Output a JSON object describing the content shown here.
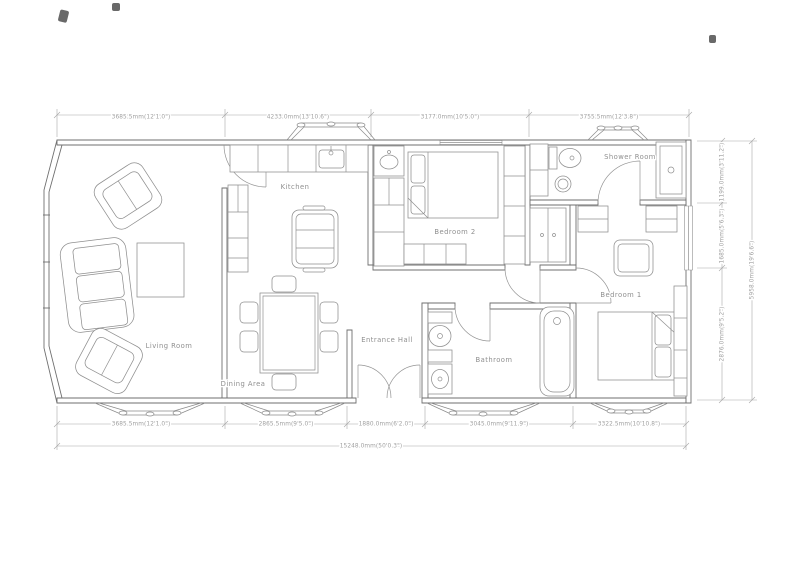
{
  "rooms": {
    "living_room": "Living Room",
    "dining_area": "Dining Area",
    "kitchen": "Kitchen",
    "entrance_hall": "Entrance Hall",
    "bathroom": "Bathroom",
    "bedroom_2": "Bedroom 2",
    "bedroom_1": "Bedroom 1",
    "shower_room": "Shower Room"
  },
  "dimensions": {
    "top": [
      "3685.5mm(12'1.0\")",
      "4233.0mm(13'10.6\")",
      "3177.0mm(10'5.0\")",
      "3755.5mm(12'3.8\")"
    ],
    "bottom": [
      "3685.5mm(12'1.0\")",
      "2865.5mm(9'5.0\")",
      "1880.0mm(6'2.0\")",
      "3045.0mm(9'11.9\")",
      "3322.5mm(10'10.8\")"
    ],
    "bottom_total": "15248.0mm(50'0.3\")",
    "right": [
      "1199.0mm(3'11.2\")",
      "1685.0mm(5'6.3\")",
      "2876.0mm(9'5.2\")"
    ],
    "right_total": "5958.0mm(19'6.6\")"
  },
  "colors": {
    "background": "#ffffff",
    "wall": "#6f6f6f",
    "furniture": "#8f8f8f",
    "dimension": "#a0a0a0",
    "label_text": "#8f8f8f"
  }
}
